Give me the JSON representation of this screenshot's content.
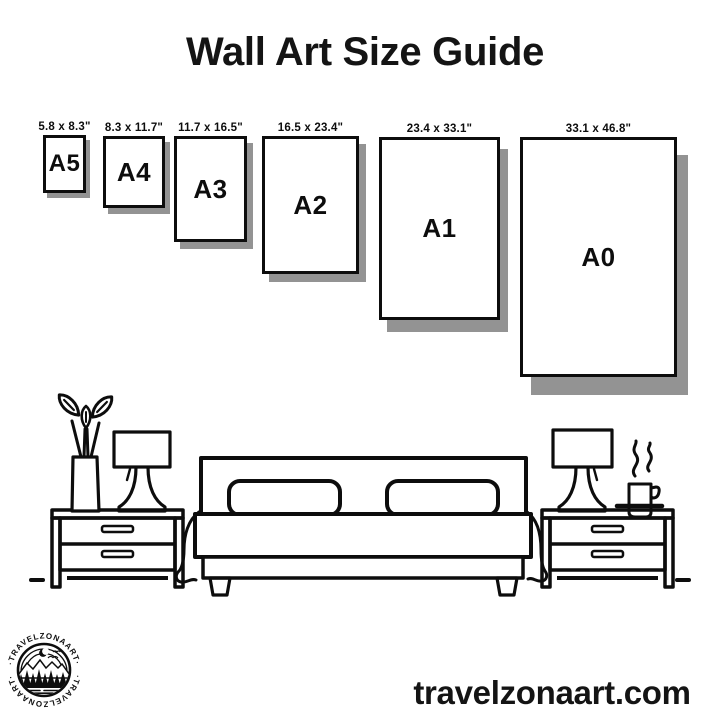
{
  "title": "Wall Art Size Guide",
  "frames": [
    {
      "name": "A5",
      "size_label": "5.8 x 8.3\""
    },
    {
      "name": "A4",
      "size_label": "8.3 x 11.7\""
    },
    {
      "name": "A3",
      "size_label": "11.7 x 16.5\""
    },
    {
      "name": "A2",
      "size_label": "16.5 x 23.4\""
    },
    {
      "name": "A1",
      "size_label": "23.4 x 33.1\""
    },
    {
      "name": "A0",
      "size_label": "33.1 x 46.8\""
    }
  ],
  "footer": {
    "website": "travelzonaart.com"
  },
  "logo": {
    "top_text": "·TRAVELZONAART·",
    "bottom_text": "·TRAVELZONAART·"
  },
  "colors": {
    "ink": "#0d0d0d",
    "shadow": "#939393",
    "background": "#ffffff"
  },
  "scene_icons": [
    "vase-with-leaves-icon",
    "table-lamp-icon",
    "nightstand-icon",
    "bed-with-pillows-icon",
    "coffee-cup-steam-icon",
    "floor-line"
  ]
}
